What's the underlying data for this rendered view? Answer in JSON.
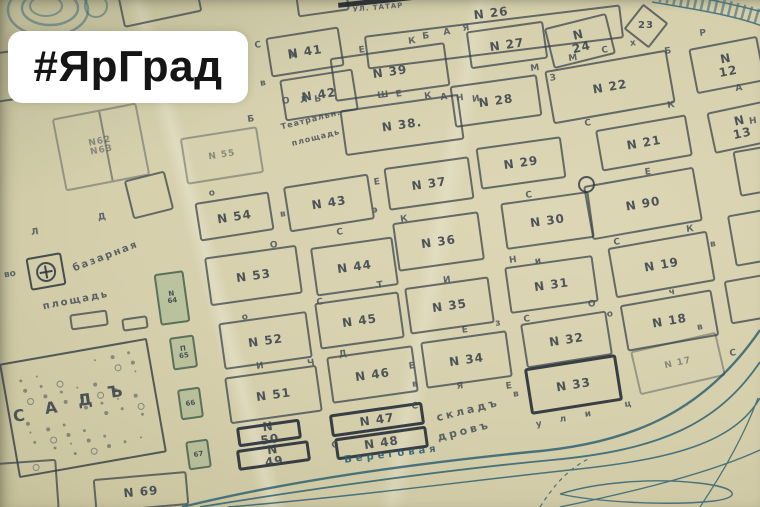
{
  "badge": {
    "text": "#ЯрГрад"
  },
  "map": {
    "description": "old-city-plan-with-numbered-blocks",
    "colors": {
      "paper": "#d5cfab",
      "ink": "#3a434d",
      "river": "#2f6373",
      "green_tint": "#6f9a74",
      "badge_bg": "#ffffff",
      "badge_text": "#151515"
    },
    "blocks": [
      {
        "label": "N 26",
        "x": 365,
        "y": 20,
        "w": 258,
        "h": 34,
        "rot": -7,
        "ly": -15
      },
      {
        "label": "N 41",
        "x": 268,
        "y": 32,
        "w": 74,
        "h": 40,
        "rot": -9
      },
      {
        "label": "N 42",
        "x": 282,
        "y": 74,
        "w": 74,
        "h": 42,
        "rot": -9
      },
      {
        "label": "N 39",
        "x": 332,
        "y": 50,
        "w": 116,
        "h": 44,
        "rot": -8
      },
      {
        "label": "N 38.",
        "x": 342,
        "y": 102,
        "w": 120,
        "h": 46,
        "rot": -8
      },
      {
        "label": "N 27",
        "x": 468,
        "y": 26,
        "w": 78,
        "h": 38,
        "rot": -8
      },
      {
        "label": "N 24",
        "x": 548,
        "y": 20,
        "w": 64,
        "h": 42,
        "rot": -14
      },
      {
        "label": "23",
        "x": 630,
        "y": 10,
        "w": 32,
        "h": 32,
        "rot": 38,
        "shape": "diamond"
      },
      {
        "label": "N 22",
        "x": 548,
        "y": 60,
        "w": 124,
        "h": 54,
        "rot": -10
      },
      {
        "label": "N 12",
        "x": 692,
        "y": 42,
        "w": 70,
        "h": 46,
        "rot": -11
      },
      {
        "label": "N 28",
        "x": 452,
        "y": 80,
        "w": 88,
        "h": 42,
        "rot": -8
      },
      {
        "label": "N 13",
        "x": 710,
        "y": 106,
        "w": 62,
        "h": 42,
        "rot": -12
      },
      {
        "label": "N 21",
        "x": 598,
        "y": 122,
        "w": 92,
        "h": 42,
        "rot": -10
      },
      {
        "label": "N 29",
        "x": 478,
        "y": 142,
        "w": 86,
        "h": 42,
        "rot": -8
      },
      {
        "label": "N 37",
        "x": 386,
        "y": 162,
        "w": 86,
        "h": 43,
        "rot": -8
      },
      {
        "label": "N 43",
        "x": 286,
        "y": 180,
        "w": 86,
        "h": 46,
        "rot": -9
      },
      {
        "label": "N 55",
        "x": 183,
        "y": 132,
        "w": 78,
        "h": 47,
        "rot": -9,
        "faint": true
      },
      {
        "label": "N 54",
        "x": 197,
        "y": 197,
        "w": 75,
        "h": 39,
        "rot": -9
      },
      {
        "label": "N62 N63",
        "x": 58,
        "y": 110,
        "w": 86,
        "h": 74,
        "rot": -11,
        "faint": true,
        "divider": true
      },
      {
        "label": "N 53",
        "x": 207,
        "y": 251,
        "w": 93,
        "h": 49,
        "rot": -8
      },
      {
        "label": "N 44",
        "x": 313,
        "y": 242,
        "w": 83,
        "h": 49,
        "rot": -8
      },
      {
        "label": "N 36",
        "x": 395,
        "y": 217,
        "w": 87,
        "h": 49,
        "rot": -8
      },
      {
        "label": "N 30",
        "x": 503,
        "y": 197,
        "w": 89,
        "h": 47,
        "rot": -8
      },
      {
        "label": "N 90",
        "x": 587,
        "y": 176,
        "w": 112,
        "h": 55,
        "rot": -10
      },
      {
        "label": "N 19",
        "x": 611,
        "y": 239,
        "w": 101,
        "h": 51,
        "rot": -10
      },
      {
        "label": "N 64",
        "x": 157,
        "y": 272,
        "w": 30,
        "h": 52,
        "rot": -8,
        "tint": true,
        "small": true,
        "stack": true
      },
      {
        "label": "N 45",
        "x": 317,
        "y": 297,
        "w": 85,
        "h": 47,
        "rot": -8
      },
      {
        "label": "N 35",
        "x": 407,
        "y": 282,
        "w": 85,
        "h": 47,
        "rot": -8
      },
      {
        "label": "N 31",
        "x": 507,
        "y": 261,
        "w": 89,
        "h": 47,
        "rot": -8
      },
      {
        "label": "N 18",
        "x": 623,
        "y": 297,
        "w": 93,
        "h": 47,
        "rot": -10
      },
      {
        "label": "N 52",
        "x": 221,
        "y": 317,
        "w": 89,
        "h": 47,
        "rot": -8
      },
      {
        "label": "N 46",
        "x": 329,
        "y": 351,
        "w": 87,
        "h": 47,
        "rot": -8
      },
      {
        "label": "N 34",
        "x": 423,
        "y": 336,
        "w": 87,
        "h": 47,
        "rot": -8
      },
      {
        "label": "N 32",
        "x": 523,
        "y": 317,
        "w": 87,
        "h": 45,
        "rot": -9
      },
      {
        "label": "N 17",
        "x": 634,
        "y": 341,
        "w": 88,
        "h": 45,
        "rot": -13,
        "faint": true
      },
      {
        "label": "N 51",
        "x": 227,
        "y": 371,
        "w": 93,
        "h": 47,
        "rot": -8
      },
      {
        "label": "N 33",
        "x": 527,
        "y": 361,
        "w": 93,
        "h": 47,
        "rot": -9,
        "bold": true
      },
      {
        "label": "N 47",
        "x": 330,
        "y": 408,
        "w": 94,
        "h": 23,
        "rot": -8,
        "bold": true
      },
      {
        "label": "N 48",
        "x": 335,
        "y": 432,
        "w": 93,
        "h": 22,
        "rot": -8,
        "bold": true
      },
      {
        "label": "N 50",
        "x": 237,
        "y": 423,
        "w": 64,
        "h": 20,
        "rot": -8,
        "bold": true
      },
      {
        "label": "N 49",
        "x": 237,
        "y": 445,
        "w": 73,
        "h": 21,
        "rot": -8,
        "bold": true
      },
      {
        "label": "N 69",
        "x": 94,
        "y": 475,
        "w": 94,
        "h": 34,
        "rot": -5
      },
      {
        "label": "П 65",
        "x": 171,
        "y": 336,
        "w": 25,
        "h": 33,
        "rot": -8,
        "tint": true,
        "small": true,
        "stack": true
      },
      {
        "label": "66",
        "x": 179,
        "y": 388,
        "w": 23,
        "h": 31,
        "rot": -8,
        "tint": true,
        "small": true
      },
      {
        "label": "67",
        "x": 187,
        "y": 440,
        "w": 23,
        "h": 29,
        "rot": -8,
        "tint": true,
        "small": true
      }
    ],
    "edge_blocks": [
      {
        "x": 120,
        "y": -12,
        "w": 80,
        "h": 32,
        "rot": -12
      },
      {
        "x": 296,
        "y": -16,
        "w": 52,
        "h": 30,
        "rot": -8
      },
      {
        "x": -30,
        "y": 52,
        "w": 60,
        "h": 50,
        "rot": -8
      },
      {
        "x": 736,
        "y": 146,
        "w": 60,
        "h": 46,
        "rot": -10
      },
      {
        "x": 731,
        "y": 210,
        "w": 60,
        "h": 52,
        "rot": -10
      },
      {
        "x": 727,
        "y": 276,
        "w": 56,
        "h": 44,
        "rot": -10
      },
      {
        "x": 70,
        "y": 312,
        "w": 38,
        "h": 16,
        "rot": -8
      },
      {
        "x": 122,
        "y": 317,
        "w": 26,
        "h": 13,
        "rot": -8
      },
      {
        "x": 128,
        "y": 175,
        "w": 42,
        "h": 40,
        "rot": -14
      },
      {
        "x": -34,
        "y": 462,
        "w": 92,
        "h": 50,
        "rot": -4
      }
    ],
    "garden": {
      "x": 8,
      "y": 350,
      "w": 150,
      "h": 116,
      "rot": -10
    },
    "street_letters": [
      {
        "ch": "С",
        "x": 258,
        "y": 46
      },
      {
        "ch": "М",
        "x": 293,
        "y": 57
      },
      {
        "ch": "Е",
        "x": 362,
        "y": 51
      },
      {
        "ch": "К",
        "x": 412,
        "y": 42
      },
      {
        "ch": "Б",
        "x": 426,
        "y": 37
      },
      {
        "ch": "А",
        "x": 447,
        "y": 33
      },
      {
        "ch": "Я",
        "x": 466,
        "y": 29
      },
      {
        "ch": "в",
        "x": 263,
        "y": 84
      },
      {
        "ch": "О",
        "x": 286,
        "y": 102
      },
      {
        "ch": "Л",
        "x": 304,
        "y": 101
      },
      {
        "ch": "Ь",
        "x": 318,
        "y": 100
      },
      {
        "ch": "Ш",
        "x": 383,
        "y": 96
      },
      {
        "ch": "Е",
        "x": 399,
        "y": 95
      },
      {
        "ch": "К",
        "x": 428,
        "y": 97
      },
      {
        "ch": "А",
        "x": 444,
        "y": 98
      },
      {
        "ch": "Н",
        "x": 460,
        "y": 99
      },
      {
        "ch": "И",
        "x": 476,
        "y": 100
      },
      {
        "ch": "М",
        "x": 573,
        "y": 59
      },
      {
        "ch": "С",
        "x": 605,
        "y": 51
      },
      {
        "ch": "х",
        "x": 633,
        "y": 44
      },
      {
        "ch": "Р",
        "x": 703,
        "y": 34
      },
      {
        "ch": "Б",
        "x": 668,
        "y": 52
      },
      {
        "ch": "М",
        "x": 535,
        "y": 69
      },
      {
        "ch": "З",
        "x": 553,
        "y": 79
      },
      {
        "ch": "А",
        "x": 739,
        "y": 89
      },
      {
        "ch": "С",
        "x": 588,
        "y": 124
      },
      {
        "ch": "К",
        "x": 671,
        "y": 106
      },
      {
        "ch": "Н",
        "x": 753,
        "y": 122
      },
      {
        "ch": "Б",
        "x": 251,
        "y": 120
      },
      {
        "ch": "о",
        "x": 212,
        "y": 194
      },
      {
        "ch": "Л",
        "x": 35,
        "y": 233
      },
      {
        "ch": "Д",
        "x": 102,
        "y": 218
      },
      {
        "ch": "во",
        "x": 10,
        "y": 275
      },
      {
        "ch": "О",
        "x": 274,
        "y": 246
      },
      {
        "ch": "С",
        "x": 340,
        "y": 233
      },
      {
        "ch": "в",
        "x": 283,
        "y": 215
      },
      {
        "ch": "К",
        "x": 404,
        "y": 220
      },
      {
        "ch": "Е",
        "x": 377,
        "y": 183
      },
      {
        "ch": "э",
        "x": 375,
        "y": 211
      },
      {
        "ch": "Т",
        "x": 380,
        "y": 286
      },
      {
        "ch": "И",
        "x": 447,
        "y": 281
      },
      {
        "ch": "Е",
        "x": 465,
        "y": 331
      },
      {
        "ch": "з",
        "x": 498,
        "y": 324
      },
      {
        "ch": "С",
        "x": 529,
        "y": 196
      },
      {
        "ch": "Е",
        "x": 648,
        "y": 173
      },
      {
        "ch": "Н",
        "x": 513,
        "y": 261
      },
      {
        "ch": "и",
        "x": 538,
        "y": 262
      },
      {
        "ch": "С",
        "x": 617,
        "y": 243
      },
      {
        "ch": "К",
        "x": 690,
        "y": 230
      },
      {
        "ch": "в",
        "x": 713,
        "y": 245
      },
      {
        "ch": "ч",
        "x": 672,
        "y": 293
      },
      {
        "ch": "О",
        "x": 592,
        "y": 305
      },
      {
        "ch": "о",
        "x": 610,
        "y": 315
      },
      {
        "ch": "С",
        "x": 527,
        "y": 320
      },
      {
        "ch": "о",
        "x": 245,
        "y": 318
      },
      {
        "ch": "С",
        "x": 320,
        "y": 303
      },
      {
        "ch": "И",
        "x": 260,
        "y": 367
      },
      {
        "ch": "Ч",
        "x": 311,
        "y": 364
      },
      {
        "ch": "Д",
        "x": 343,
        "y": 355
      },
      {
        "ch": "Е",
        "x": 412,
        "y": 367
      },
      {
        "ch": "в",
        "x": 415,
        "y": 385
      },
      {
        "ch": "Я",
        "x": 460,
        "y": 387
      },
      {
        "ch": "С",
        "x": 415,
        "y": 407
      },
      {
        "ch": "С",
        "x": 335,
        "y": 446
      },
      {
        "ch": "у",
        "x": 539,
        "y": 425
      },
      {
        "ch": "л",
        "x": 563,
        "y": 420
      },
      {
        "ch": "и",
        "x": 588,
        "y": 415
      },
      {
        "ch": "ц",
        "x": 628,
        "y": 405
      },
      {
        "ch": "С",
        "x": 733,
        "y": 354
      },
      {
        "ch": "в",
        "x": 700,
        "y": 328
      },
      {
        "ch": "Е",
        "x": 509,
        "y": 387
      },
      {
        "ch": "в",
        "x": 516,
        "y": 395
      },
      {
        "ch": "С",
        "x": 20,
        "y": 416,
        "big": true
      },
      {
        "ch": "А",
        "x": 52,
        "y": 408,
        "big": true
      },
      {
        "ch": "Д",
        "x": 86,
        "y": 400,
        "big": true
      },
      {
        "ch": "Ъ",
        "x": 116,
        "y": 392,
        "big": true
      }
    ],
    "labels": [
      {
        "text": "УЛ. ТАТАР",
        "x": 378,
        "y": 8,
        "rot": -5,
        "size": 7,
        "spacing": 1
      },
      {
        "text": "Театральн.",
        "x": 311,
        "y": 120,
        "rot": -14,
        "size": 8,
        "spacing": 1
      },
      {
        "text": "площадь",
        "x": 316,
        "y": 138,
        "rot": -14,
        "size": 8,
        "spacing": 1
      },
      {
        "text": "базарная",
        "x": 106,
        "y": 257,
        "rot": -21,
        "size": 10,
        "spacing": 2
      },
      {
        "text": "площадь",
        "x": 76,
        "y": 301,
        "rot": -11,
        "size": 10,
        "spacing": 2
      },
      {
        "text": "складъ",
        "x": 468,
        "y": 410,
        "rot": -14,
        "size": 11,
        "spacing": 3
      },
      {
        "text": "дровъ",
        "x": 464,
        "y": 431,
        "rot": -14,
        "size": 11,
        "spacing": 3
      },
      {
        "text": "Береговая",
        "x": 392,
        "y": 455,
        "rot": -7,
        "size": 10,
        "spacing": 4,
        "blue": true
      }
    ],
    "symbols": {
      "church": {
        "x": 28,
        "y": 255,
        "w": 36,
        "h": 33,
        "rot": -10
      },
      "ring": {
        "x": 578,
        "y": 176,
        "d": 17
      },
      "street_bar": {
        "x": 338,
        "y": -2,
        "w": 92,
        "h": 5,
        "rot": -6
      }
    }
  }
}
